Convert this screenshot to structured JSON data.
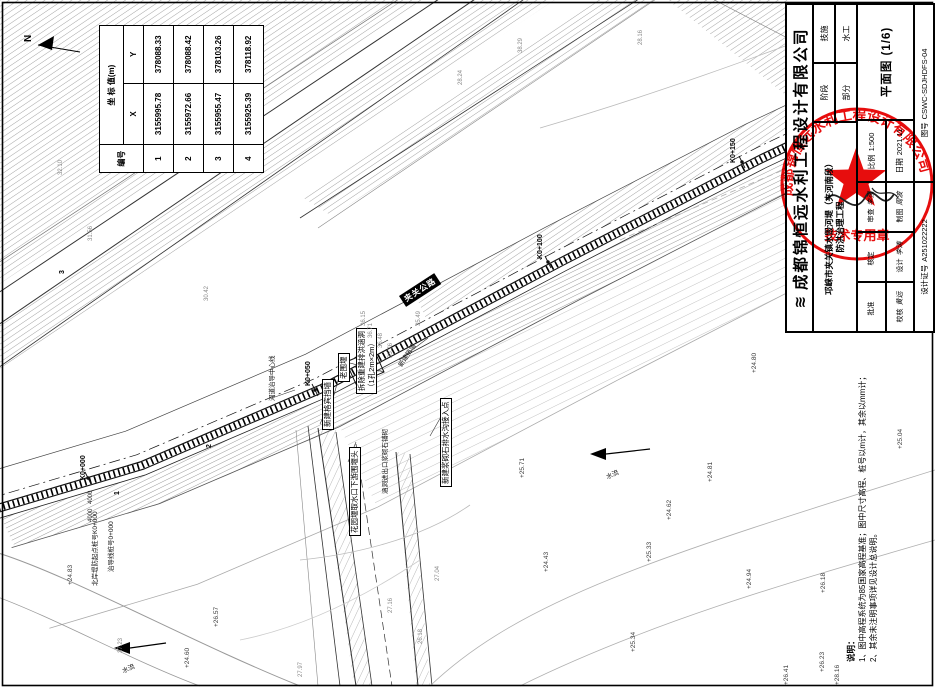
{
  "title_block": {
    "logo": "≋",
    "company": "成都锦恒远水利工程设计有限公司",
    "project_line1": "邛崃市夹关镇水毁河堤（夹河南段）",
    "project_line2": "防洪治理工程",
    "stage_label": "阶段",
    "stage_value": "技施",
    "part_label": "部分",
    "part_value": "水工",
    "drawing_title": "平面图 (1/6)",
    "scale_label": "比例",
    "scale_value": "1:500",
    "date_label": "日期",
    "date_value": "2021.11",
    "no_label": "图号",
    "no_value": "CSWC-SDJHDFS-04",
    "cert_label": "设计证号",
    "cert_value": "A251022222",
    "signatures": [
      {
        "label": "批准",
        "name": ""
      },
      {
        "label": "核定",
        "name": ""
      },
      {
        "label": "审查",
        "name": "李强"
      },
      {
        "label": "校核",
        "name": "黄远"
      },
      {
        "label": "设计",
        "name": "李涛"
      },
      {
        "label": "制图",
        "name": "周波"
      }
    ]
  },
  "stamp": {
    "ring_text": "成都锦恒远水利工程设计有限公司",
    "caption": "技术专用章",
    "color": "#e60000"
  },
  "coord_table": {
    "header": "坐 标 值(m)",
    "col_id": "编号",
    "col_x": "X",
    "col_y": "Y",
    "points": [
      {
        "id": "1",
        "x": "3155995.78",
        "y": "378088.33"
      },
      {
        "id": "2",
        "x": "3155972.66",
        "y": "378088.42"
      },
      {
        "id": "3",
        "x": "3155955.47",
        "y": "378103.26"
      },
      {
        "id": "4",
        "x": "3155925.39",
        "y": "378118.92"
      }
    ]
  },
  "notes": {
    "title": "说明：",
    "items": [
      {
        "t": "1、图中高程系统为85国家高程基准；图中尺寸高程、桩号以m计，其余以mm计；"
      },
      {
        "t": "2、其余未注明事项详见设计总说明。"
      }
    ]
  },
  "north_label": "N",
  "road_label": {
    "t": "夹关公路"
  },
  "culvert_label": {
    "line1": "拆除重建排洪涵洞",
    "line2": "（1孔2m×2m）"
  },
  "labels": {
    "stations": [
      {
        "t": "K0+000",
        "px": 80,
        "py": 480
      },
      {
        "t": "K0+050",
        "px": 305,
        "py": 386
      },
      {
        "t": "K0+100",
        "px": 537,
        "py": 259
      },
      {
        "t": "K0+150",
        "px": 730,
        "py": 163
      }
    ],
    "boxed": [
      {
        "t": "老围堰",
        "px": 338,
        "py": 382
      },
      {
        "t": "新建格宾挡墙",
        "px": 322,
        "py": 430
      },
      {
        "t": "花园堰取水口下游围堰头",
        "px": 349,
        "py": 536
      },
      {
        "t": "新建浆砌石排水沟接入点",
        "px": 440,
        "py": 487
      }
    ],
    "plain": [
      {
        "t": "河道治导中心线",
        "px": 266,
        "py": 401
      },
      {
        "t": "涵洞进出口浆砌石铺砌",
        "px": 379,
        "py": 494
      },
      {
        "t": "北岸堤防起点桩号K0+000",
        "px": 89,
        "py": 586
      },
      {
        "t": "治导线桩号0+000",
        "px": 105,
        "py": 572
      },
      {
        "t": "新建挡墙",
        "px": 395,
        "py": 363,
        "rot": -57
      },
      {
        "t": "水流",
        "px": 604,
        "py": 472,
        "rot": -25
      },
      {
        "t": "水流",
        "px": 120,
        "py": 666,
        "rot": -25
      }
    ],
    "elevations": [
      {
        "t": "+24.80",
        "px": 751,
        "py": 373
      },
      {
        "t": "+25.71",
        "px": 519,
        "py": 478
      },
      {
        "t": "+24.81",
        "px": 707,
        "py": 482
      },
      {
        "t": "+24.62",
        "px": 666,
        "py": 520
      },
      {
        "t": "+24.43",
        "px": 543,
        "py": 572
      },
      {
        "t": "+25.33",
        "px": 646,
        "py": 562
      },
      {
        "t": "+25.34",
        "px": 630,
        "py": 652
      },
      {
        "t": "+26.23",
        "px": 819,
        "py": 672
      },
      {
        "t": "+26.41",
        "px": 783,
        "py": 685
      },
      {
        "t": "+24.60",
        "px": 184,
        "py": 668
      },
      {
        "t": "+26.57",
        "px": 213,
        "py": 627
      },
      {
        "t": "+28.16",
        "px": 834,
        "py": 685
      },
      {
        "t": "+24.83",
        "px": 67,
        "py": 585
      },
      {
        "t": "+25.04",
        "px": 897,
        "py": 449
      },
      {
        "t": "+26.18",
        "px": 820,
        "py": 593
      },
      {
        "t": "+24.94",
        "px": 746,
        "py": 589
      }
    ],
    "gray_numbers": [
      {
        "t": "36.15",
        "px": 361,
        "py": 326
      },
      {
        "t": "36.71",
        "px": 368,
        "py": 338
      },
      {
        "t": "36.48",
        "px": 378,
        "py": 348
      },
      {
        "t": "35.76",
        "px": 388,
        "py": 358
      },
      {
        "t": "35.49",
        "px": 416,
        "py": 326
      },
      {
        "t": "33.10",
        "px": 148,
        "py": 121
      },
      {
        "t": "32.07",
        "px": 158,
        "py": 134
      },
      {
        "t": "32.21",
        "px": 168,
        "py": 147
      },
      {
        "t": "31.92",
        "px": 138,
        "py": 105
      },
      {
        "t": "33.21",
        "px": 126,
        "py": 89
      },
      {
        "t": "27.23",
        "px": 118,
        "py": 653
      },
      {
        "t": "27.04",
        "px": 435,
        "py": 581
      },
      {
        "t": "27.16",
        "px": 388,
        "py": 613
      },
      {
        "t": "26.18",
        "px": 418,
        "py": 644
      },
      {
        "t": "28.24",
        "px": 458,
        "py": 85
      },
      {
        "t": "38.29",
        "px": 518,
        "py": 53
      },
      {
        "t": "35.08",
        "px": 248,
        "py": 55
      },
      {
        "t": "32.10",
        "px": 58,
        "py": 175
      },
      {
        "t": "27.97",
        "px": 298,
        "py": 677
      },
      {
        "t": "28.16",
        "px": 638,
        "py": 45
      },
      {
        "t": "31.56",
        "px": 88,
        "py": 241
      },
      {
        "t": "30.42",
        "px": 204,
        "py": 301
      }
    ],
    "markers": [
      {
        "t": "1",
        "px": 114,
        "py": 495
      },
      {
        "t": "2",
        "px": 206,
        "py": 448
      },
      {
        "t": "3",
        "px": 59,
        "py": 274
      }
    ],
    "dims": [
      {
        "t": "4000",
        "px": 88,
        "py": 504
      },
      {
        "t": "4000",
        "px": 88,
        "py": 522
      }
    ]
  }
}
